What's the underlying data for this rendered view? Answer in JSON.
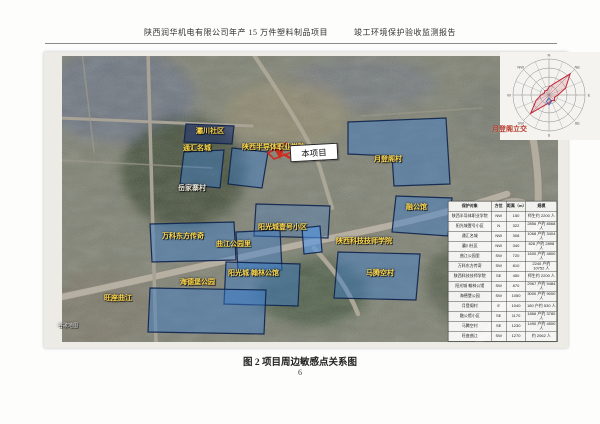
{
  "page": {
    "header_left": "陕西润华机电有限公司年产 15 万件塑料制品项目",
    "header_right": "竣工环境保护验收监测报告",
    "caption": "图 2  项目周边敏感点关系图",
    "page_number": "6"
  },
  "map": {
    "project_callout": "本项目",
    "accent_colors": {
      "label_yellow": "#ffd84d",
      "highlight_blue": "#3a7ccd",
      "arrow_red": "#cf2b20"
    },
    "windrose": {
      "directions": [
        "N",
        "NE",
        "E",
        "SE",
        "S",
        "SW",
        "W",
        "NW"
      ]
    },
    "labels": [
      {
        "t": "灞川社区",
        "x": 152,
        "y": 76
      },
      {
        "t": "通汇名城",
        "x": 139,
        "y": 93
      },
      {
        "t": "陕西半导体职业学院",
        "x": 198,
        "y": 92,
        "w": 70,
        "cls": "wrap"
      },
      {
        "t": "岳家寨村",
        "x": 134,
        "y": 133,
        "cls": "light"
      },
      {
        "t": "月登阁村",
        "x": 330,
        "y": 104
      },
      {
        "t": "月登阁立交",
        "x": 448,
        "y": 74,
        "cls": "red"
      },
      {
        "t": "融公馆",
        "x": 362,
        "y": 152
      },
      {
        "t": "阳光城壹号小区",
        "x": 214,
        "y": 172
      },
      {
        "t": "陕西科技技师学院",
        "x": 292,
        "y": 186,
        "w": 62,
        "cls": "wrap"
      },
      {
        "t": "马腾空村",
        "x": 322,
        "y": 218
      },
      {
        "t": "阳光城 翰林公馆",
        "x": 184,
        "y": 218
      },
      {
        "t": "万科东方传奇",
        "x": 118,
        "y": 181
      },
      {
        "t": "曲江公园里",
        "x": 172,
        "y": 189
      },
      {
        "t": "海德堡公园",
        "x": 136,
        "y": 227
      },
      {
        "t": "旺座曲江",
        "x": 60,
        "y": 243
      },
      {
        "t": "谷歌地图",
        "x": 14,
        "y": 272,
        "cls": "tiny"
      }
    ]
  },
  "table": {
    "headers": [
      "保护对象",
      "方位",
      "距离（m）",
      "规模"
    ],
    "rows": [
      {
        "name": "陕西半导体职业学院",
        "direction": "NW",
        "distance_m": "150",
        "scale": "师生约 2200 人"
      },
      {
        "name": "阳光城壹号小区",
        "direction": "N",
        "distance_m": "322",
        "scale": "2856 户约 8568 人"
      },
      {
        "name": "通汇名城",
        "direction": "NW",
        "distance_m": "308",
        "scale": "1068 户约 3404 人"
      },
      {
        "name": "灞川社区",
        "direction": "NW",
        "distance_m": "340",
        "scale": "828 户约 2898 人"
      },
      {
        "name": "曲江公园里",
        "direction": "SW",
        "distance_m": "720",
        "scale": "1600 户约 4800 人"
      },
      {
        "name": "万科东方传奇",
        "direction": "SW",
        "distance_m": "810",
        "scale": "2240 户约 10752 人"
      },
      {
        "name": "陕西科技技师学院",
        "direction": "SE",
        "distance_m": "450",
        "scale": "师生约 2200 人"
      },
      {
        "name": "阳光城 翰林公馆",
        "direction": "SW",
        "distance_m": "870",
        "scale": "2967 户约 9484 人"
      },
      {
        "name": "海德堡公园",
        "direction": "SW",
        "distance_m": "1050",
        "scale": "3000 户约 9000 人"
      },
      {
        "name": "月登阁村",
        "direction": "E",
        "distance_m": "1040",
        "scale": "180 户约 530 人"
      },
      {
        "name": "融公馆小区",
        "direction": "SE",
        "distance_m": "1170",
        "scale": "1866 户约 3780 人"
      },
      {
        "name": "马腾空村",
        "direction": "SE",
        "distance_m": "1230",
        "scale": "1490 户约 4500 人"
      },
      {
        "name": "旺座曲江",
        "direction": "SW",
        "distance_m": "1270",
        "scale": "约 2062 人"
      }
    ]
  }
}
